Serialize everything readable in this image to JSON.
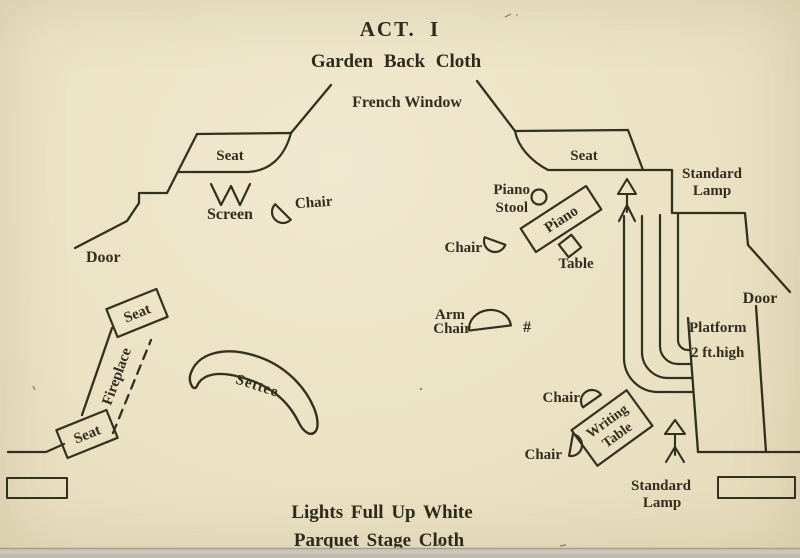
{
  "title": {
    "act": "ACT. I",
    "backcloth": "Garden Back Cloth"
  },
  "footer": {
    "lights": "Lights Full Up White",
    "cloth": "Parquet Stage Cloth"
  },
  "labels": {
    "french_window": "French Window",
    "seat_left": "Seat",
    "seat_right": "Seat",
    "screen": "Screen",
    "chair_screen": "Chair",
    "door_left": "Door",
    "door_right": "Door",
    "piano_stool_line1": "Piano",
    "piano_stool_line2": "Stool",
    "piano": "Piano",
    "table_small": "Table",
    "chair_piano": "Chair",
    "standard_lamp_top_line1": "Standard",
    "standard_lamp_top_line2": "Lamp",
    "platform_line1": "Platform",
    "platform_line2": "2 ft.high",
    "arm_chair_line1": "Arm",
    "arm_chair_line2": "Chair",
    "arm_chair_mark": "#",
    "fireplace": "Fireplace",
    "seat_fireplace_top": "Seat",
    "seat_fireplace_bottom": "Seat",
    "settee": "Settee",
    "chair_writing_top": "Chair",
    "writing_table_line1": "Writing",
    "writing_table_line2": "Table",
    "chair_writing_bottom": "Chair",
    "standard_lamp_bottom_line1": "Standard",
    "standard_lamp_bottom_line2": "Lamp"
  },
  "colors": {
    "paper": "#ebe2c4",
    "ink": "#32301f",
    "scan_edge": "#cbc6b7"
  }
}
